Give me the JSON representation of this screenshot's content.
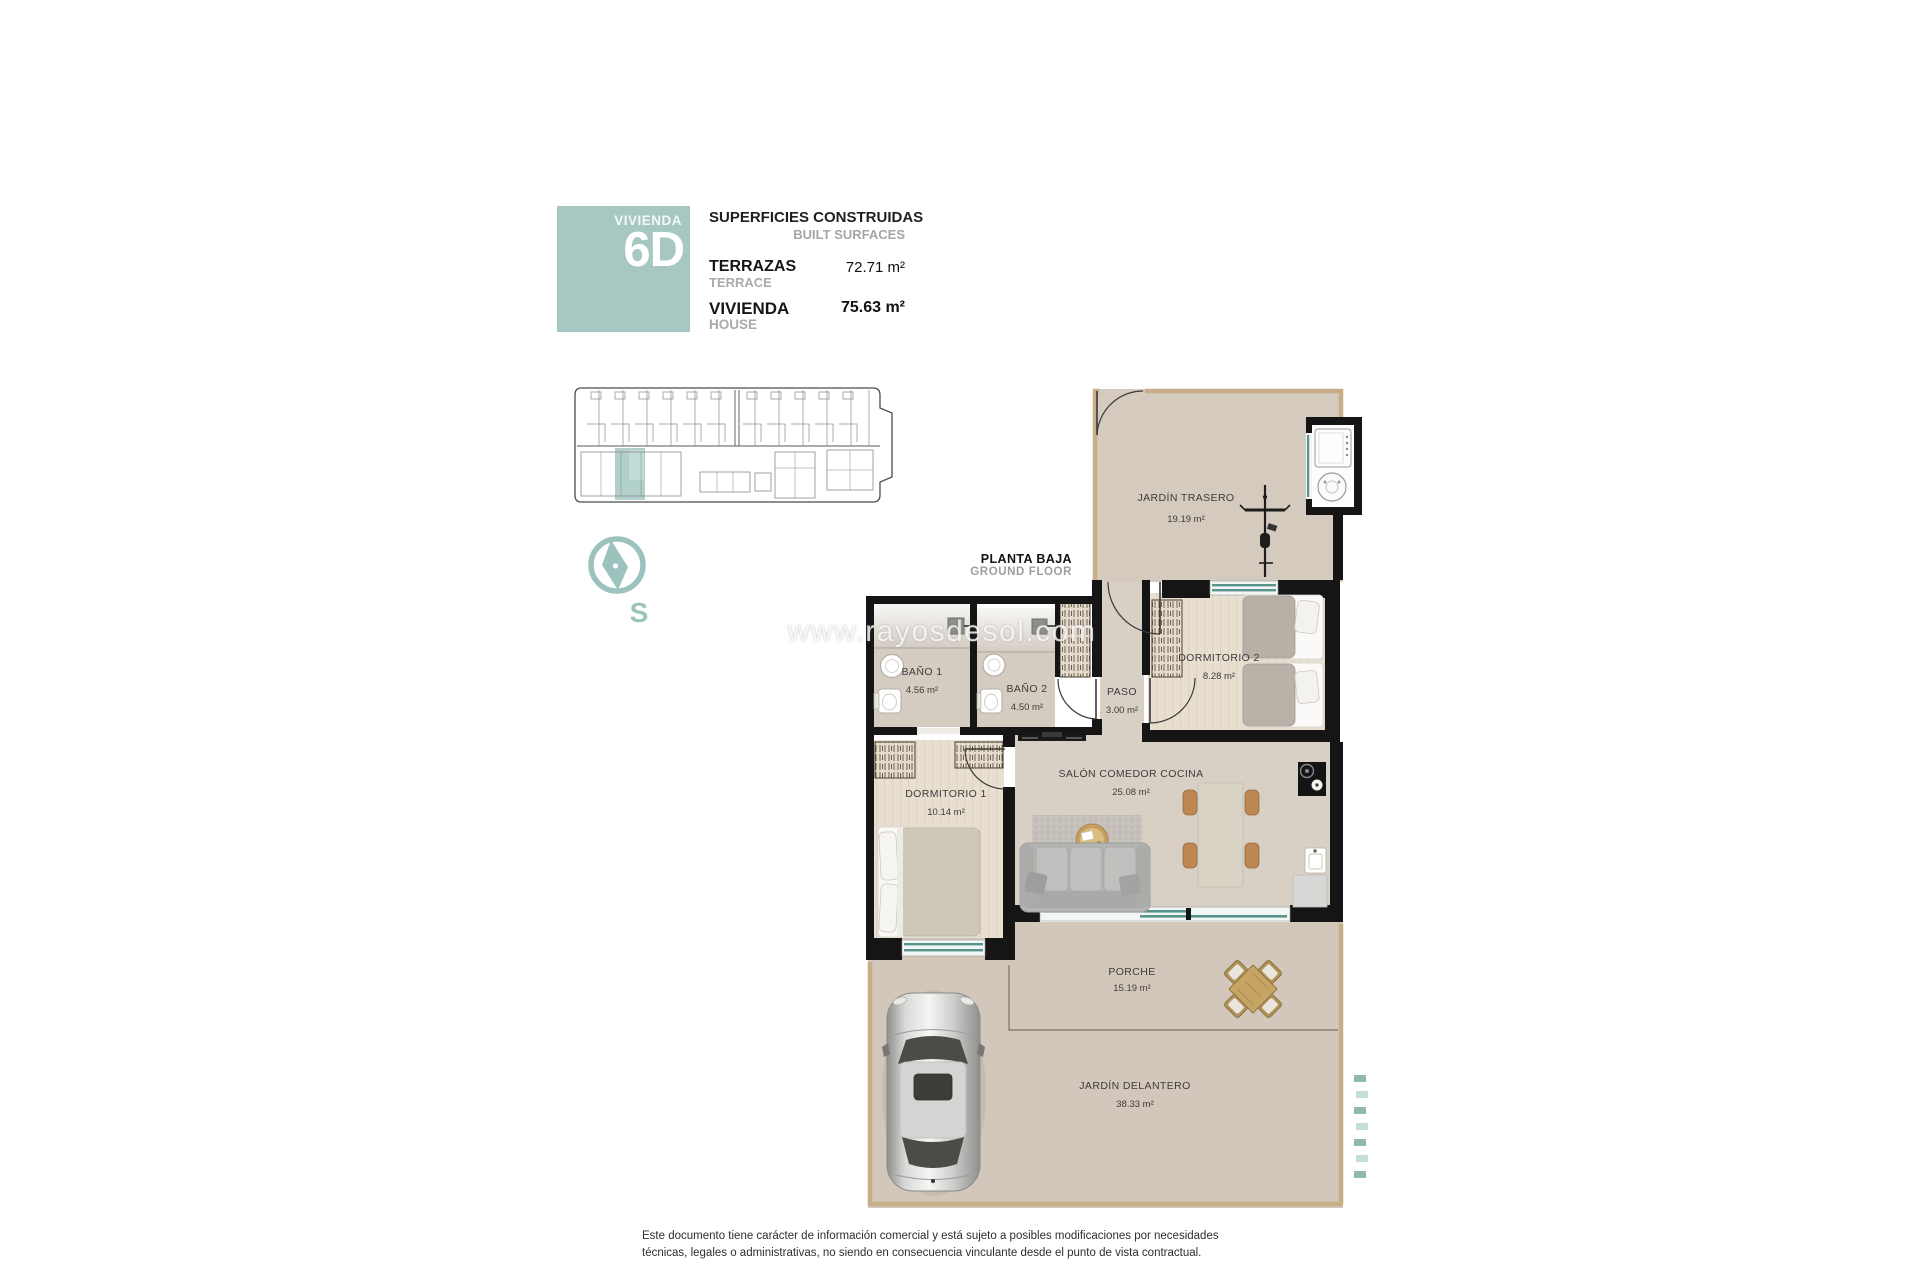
{
  "legend": {
    "unit_label": "VIVIENDA",
    "unit_number": "6D",
    "title": "SUPERFICIES CONSTRUIDAS",
    "subtitle": "BUILT SURFACES",
    "rows": [
      {
        "name": "TERRAZAS",
        "name_en": "TERRACE",
        "value": "72.71 m²"
      },
      {
        "name": "VIVIENDA",
        "name_en": "HOUSE",
        "value": "75.63 m²"
      }
    ]
  },
  "compass": {
    "south_label": "S"
  },
  "floor_label": {
    "es": "PLANTA BAJA",
    "en": "GROUND FLOOR"
  },
  "rooms": {
    "jardin_trasero": {
      "name": "JARDÍN TRASERO",
      "area": "19.19 m²"
    },
    "bano1": {
      "name": "BAÑO 1",
      "area": "4.56 m²"
    },
    "bano2": {
      "name": "BAÑO 2",
      "area": "4.50 m²"
    },
    "paso": {
      "name": "PASO",
      "area": "3.00 m²"
    },
    "dormitorio2": {
      "name": "DORMITORIO 2",
      "area": "8.28 m²"
    },
    "dormitorio1": {
      "name": "DORMITORIO 1",
      "area": "10.14 m²"
    },
    "salon": {
      "name": "SALÓN COMEDOR COCINA",
      "area": "25.08 m²"
    },
    "porche": {
      "name": "PORCHE",
      "area": "15.19 m²"
    },
    "jardin_delantero": {
      "name": "JARDÍN DELANTERO",
      "area": "38.33 m²"
    }
  },
  "watermark": "www.rayosdesol.com",
  "disclaimer": {
    "line1": "Este documento tiene carácter de información comercial y está sujeto a posibles modificaciones por necesidades",
    "line2": "técnicas, legales o administrativas, no siendo en consecuencia vinculante desde el punto de vista contractual."
  },
  "colors": {
    "accent_teal": "#a7c8c2",
    "window_teal": "#57948c",
    "wall_black": "#151515",
    "garden_floor": "#d4cabd",
    "room_floor": "#d9d0c5",
    "wood_floor": "#e8dfd0"
  }
}
